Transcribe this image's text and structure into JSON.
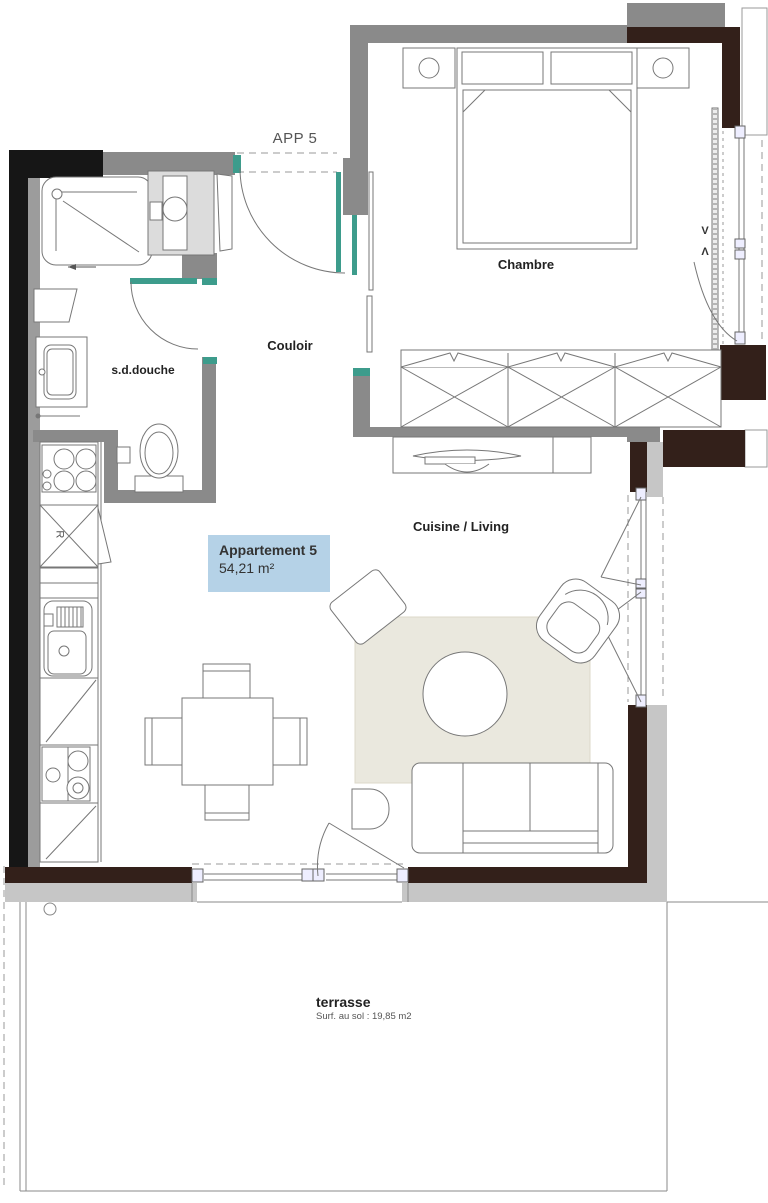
{
  "plan": {
    "app_label": "APP 5",
    "rooms": {
      "bedroom": "Chambre",
      "hallway": "Couloir",
      "bathroom": "s.d.douche",
      "kitchen_living": "Cuisine / Living"
    },
    "apartment_tag": {
      "name": "Appartement 5",
      "area": "54,21 m²"
    },
    "terrace": {
      "name": "terrasse",
      "area_note": "Surf. au sol : 19,85 m2"
    },
    "window_marks": {
      "up": "V",
      "down": "Λ"
    },
    "fridge_label": "R",
    "colors": {
      "wall_black": "#161616",
      "wall_gray": "#8a8a8a",
      "wall_brown": "#33201a",
      "slab_gray": "#c6c6c6",
      "joinery_teal": "#3d9c8c",
      "tag_background": "#b5d2e7",
      "rug": "#eae8de",
      "line": "#777777"
    }
  }
}
